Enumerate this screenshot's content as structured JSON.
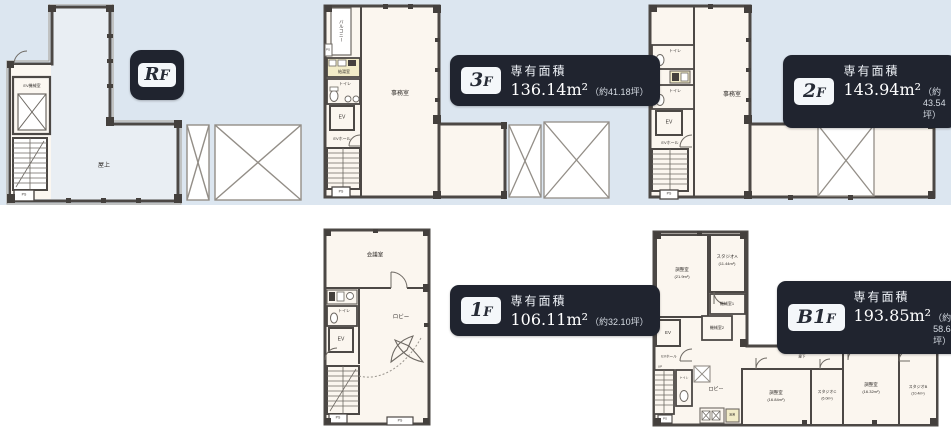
{
  "background": {
    "band_color": "#dce6f0"
  },
  "badges": {
    "rf": {
      "floor_big": "R",
      "floor_small": "F"
    },
    "f3": {
      "floor_big": "3",
      "floor_small": "F",
      "area_title": "専有面積",
      "area_value": "136.14m²",
      "area_tsubo": "（約41.18坪）"
    },
    "f2": {
      "floor_big": "2",
      "floor_small": "F",
      "area_title": "専有面積",
      "area_value": "143.94m²",
      "area_tsubo": "（約43.54坪）"
    },
    "f1": {
      "floor_big": "1",
      "floor_small": "F",
      "area_title": "専有面積",
      "area_value": "106.11m²",
      "area_tsubo": "（約32.10坪）"
    },
    "b1": {
      "floor_big": "B1",
      "floor_small": "F",
      "area_title": "専有面積",
      "area_value": "193.85m²",
      "area_tsubo": "（約58.64坪）"
    }
  },
  "plans": {
    "rf": {
      "rooftop": "屋上",
      "ev_machine": "EV機械室",
      "ps": "PS"
    },
    "f3": {
      "office": "事務室",
      "balcony": "バルコニー",
      "kitchen": "給湯室",
      "toilet": "トイレ",
      "ev": "EV",
      "ev_hall": "EVホール",
      "ps_side": "PS",
      "ps_bottom": "PS"
    },
    "f2": {
      "office": "事務室",
      "toilet_1": "トイレ",
      "toilet_2": "トイレ",
      "ev": "EV",
      "ev_hall": "EVホール",
      "ps": "PS"
    },
    "f1": {
      "meeting": "会議室",
      "lobby": "ロビー",
      "toilet": "トイレ",
      "ev": "EV",
      "ps_1": "PS",
      "ps_2": "PS"
    },
    "b1": {
      "control_a": "調整室",
      "control_a_area": "(21.9m²)",
      "studio_a": "スタジオA",
      "studio_a_area": "(11.44m²)",
      "machine_1": "機械室1",
      "machine_2": "機械室2",
      "ev": "EV",
      "ev_hall": "EVホール",
      "up": "UP",
      "toilet": "トイレ",
      "lobby": "ロビー",
      "corridor": "廊下",
      "kitchenette": "湯沸",
      "ps": "PS",
      "control_b": "調整室",
      "control_b_area": "(16.84m²)",
      "studio_c": "スタジオC",
      "studio_c_area": "(6.0m²)",
      "control_c": "調整室",
      "control_c_area": "(16.32m²)",
      "studio_b": "スタジオB",
      "studio_b_area": "(10.4m²)"
    }
  }
}
